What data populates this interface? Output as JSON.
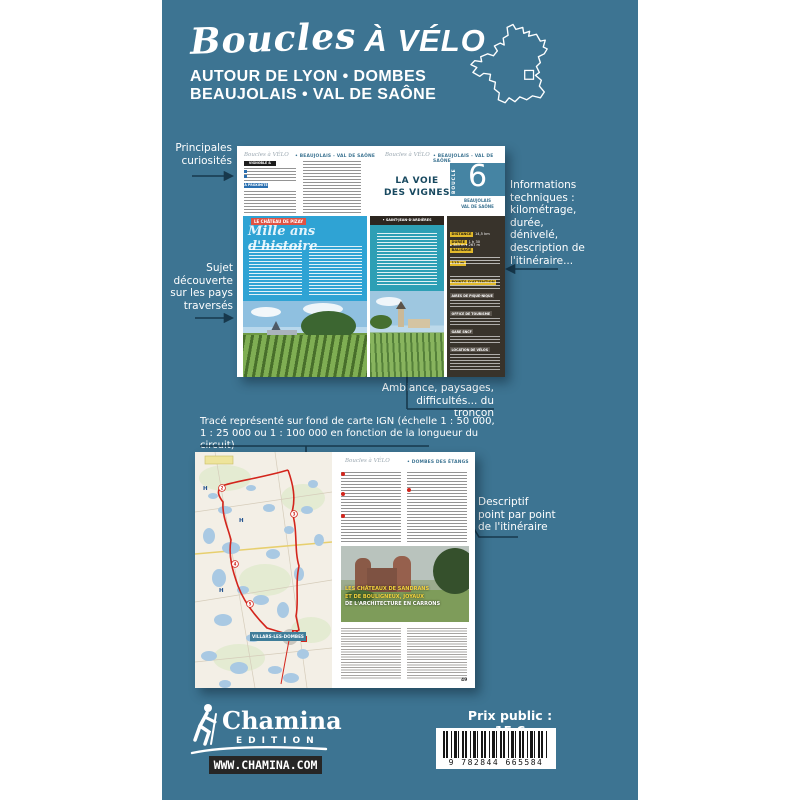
{
  "cover": {
    "bg": "#3d7492",
    "title_script": "Boucles",
    "title_bold": "À VÉLO",
    "subtitle": "AUTOUR DE LYON • DOMBES\nBEAUJOLAIS • VAL DE SAÔNE"
  },
  "annotations": {
    "principales": "Principales\ncuriosités",
    "informations": "Informations\ntechniques :\nkilométrage,\ndurée,\ndénivelé,\ndescription de\nl'itinéraire...",
    "sujet": "Sujet\ndécouverte\nsur les pays\ntraversés",
    "ambiance": "Ambiance, paysages,\ndifficultés... du tronçon",
    "trace": "Tracé représenté sur fond de carte IGN (échelle 1 : 50 000,\n1 : 25 000 ou 1 : 100 000 en fonction de la longueur du circuit)",
    "descriptif": "Descriptif\npoint par point\nde l'itinéraire"
  },
  "spread1": {
    "header_script": "Boucles à VÉLO",
    "header_region": "• BEAUJOLAIS - VAL DE SAÔNE",
    "route_title": "LA VOIE\nDES VIGNES",
    "boucle_label": "BOUCLE",
    "boucle_number": "6",
    "boucle_region": "BEAUJOLAIS\nVAL DE SAÔNE",
    "sidebar_box1": "VIGNOBLE & PATRIMOINE",
    "sidebar_box2": "À PROXIMITÉ",
    "article_chip": "LE CHÂTEAU DE PIZAY",
    "article_title": "Mille ans d'histoire",
    "section_bar": "• SAINT-JEAN-D'ARDIÈRES",
    "info": {
      "chip_distance": "DISTANCE",
      "val_distance": "14,5 km",
      "chip_duree": "DURÉE",
      "val_duree": "1 h 30",
      "chip_balisage": "BALISAGE",
      "deniv": "▴ 383 m  ▾ 267 m",
      "chip_alt": "113 m",
      "chip_attention": "POINTS D'ATTENTION",
      "bars": [
        "AIRES DE PIQUE-NIQUE",
        "OFFICE DE TOURISME",
        "GARE SNCF",
        "LOCATION DE VÉLOS"
      ]
    }
  },
  "spread2": {
    "header_script": "Boucles à VÉLO",
    "header_region": "• DOMBES DES ÉTANGS",
    "town_label": "VILLARS-LES-DOMBES",
    "caption_line1": "LES CHÂTEAUX DE SANDRANS",
    "caption_line2": "ET DE BOULIGNEUX, JOYAUX",
    "caption_line3": "DE L'ARCHITECTURE EN CARRONS",
    "page_number": "49"
  },
  "footer": {
    "brand": "Chamina",
    "brand_sub": "EDITION",
    "website": "WWW.CHAMINA.COM",
    "price": "Prix public : 15 €",
    "barcode_digits": "9 782844 665584"
  }
}
